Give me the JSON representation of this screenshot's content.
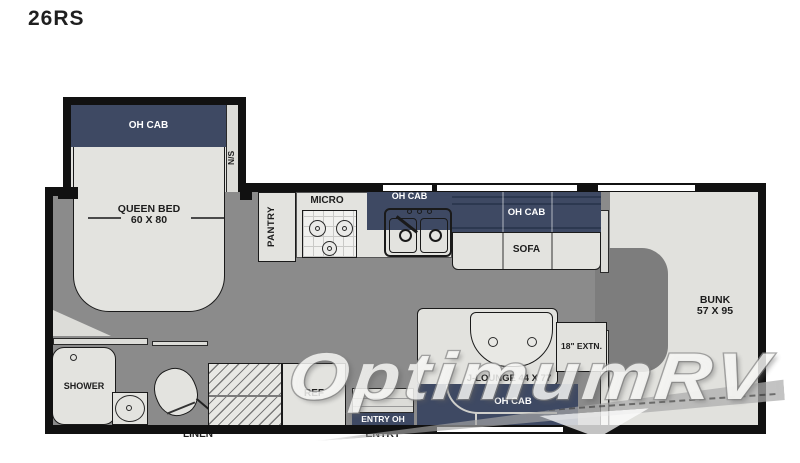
{
  "title": "26RS",
  "rooms": {
    "bedroom": {
      "oh_cab": "OH CAB",
      "nightstand": "N/S",
      "bed_name": "QUEEN BED",
      "bed_size": "60 X 80"
    },
    "bath": {
      "shower": "SHOWER",
      "linen": "LINEN"
    },
    "kitchen": {
      "pantry": "PANTRY",
      "micro": "MICRO",
      "sink_oh_cab": "OH CAB",
      "ref": "REF"
    },
    "living": {
      "sofa_oh_cab": "OH CAB",
      "sofa": "SOFA",
      "jlounge": "J-LOUNGE 44 X 77",
      "extension": "18\" EXTN.",
      "lounge_oh_cab": "OH CAB"
    },
    "entry": {
      "entry_oh": "ENTRY OH",
      "entry": "ENTRY"
    },
    "bunk": {
      "name": "BUNK",
      "size": "57 X 95"
    }
  },
  "watermark": {
    "text": "OptimumRV"
  },
  "colors": {
    "navy": "#3e4963",
    "floor": "#8b8b8b",
    "furniture": "#e3e3df",
    "wall": "#111111",
    "cab_floor": "#7d7d7d"
  }
}
